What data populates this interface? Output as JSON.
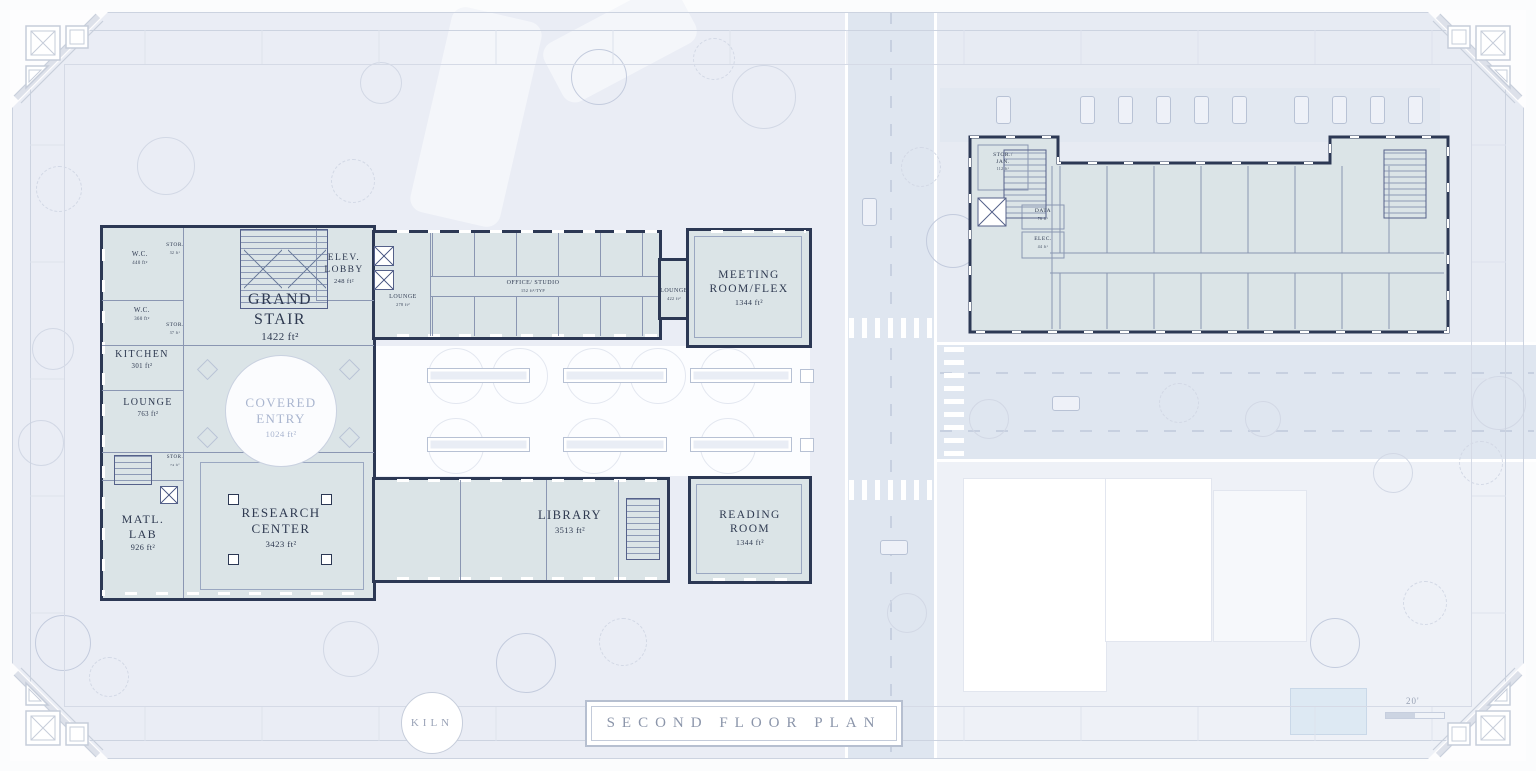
{
  "titleblock": {
    "title": "SECOND FLOOR PLAN"
  },
  "badge": {
    "label": "KILN"
  },
  "scale": {
    "label": "20'"
  },
  "colors": {
    "wall": "#2c3854",
    "room_fill": "#dbe4e7",
    "site": "#eaedf5",
    "road": "#dfe6f0",
    "label": "#2e3950",
    "light_label": "#a9b5cf"
  },
  "left_building": {
    "rooms": {
      "wc_north": {
        "name": "W.C.",
        "area": "440 ft²"
      },
      "stor_north": {
        "name": "STOR.",
        "area": "32 ft²"
      },
      "wc_south": {
        "name": "W.C.",
        "area": "360 ft²"
      },
      "stor_mid": {
        "name": "STOR.",
        "area": "37 ft²"
      },
      "kitchen": {
        "name": "KITCHEN",
        "area": "301 ft²"
      },
      "lounge_west": {
        "name": "LOUNGE",
        "area": "763 ft²"
      },
      "grand_stair": {
        "name": "GRAND STAIR",
        "area": "1422 ft²"
      },
      "elev_lobby": {
        "name": "ELEV. LOBBY",
        "area": "248 ft²"
      },
      "covered_entry": {
        "name": "COVERED ENTRY",
        "area": "1024 ft²"
      },
      "office_studio": {
        "name": "OFFICE/ STUDIO",
        "area": "152 ft²/TYP"
      },
      "lounge_mid": {
        "name": "LOUNGE",
        "area": "278 ft²"
      },
      "lounge_east": {
        "name": "LOUNGE",
        "area": "422 ft²"
      },
      "meeting_room": {
        "name": "MEETING ROOM/FLEX",
        "area": "1344 ft²"
      },
      "stor_south": {
        "name": "STOR.",
        "area": "74 ft²"
      },
      "matl_lab": {
        "name": "MATL. LAB",
        "area": "926 ft²"
      },
      "research_center": {
        "name": "RESEARCH CENTER",
        "area": "3423 ft²"
      },
      "library": {
        "name": "LIBRARY",
        "area": "3513 ft²"
      },
      "reading_room": {
        "name": "READING ROOM",
        "area": "1344 ft²"
      }
    }
  },
  "right_building": {
    "rooms": {
      "stor_jan": {
        "name": "STOR./ JAN.",
        "area": "112 ft²"
      },
      "data": {
        "name": "DATA",
        "area": "76 ft²"
      },
      "elec": {
        "name": "ELEC.",
        "area": "44 ft²"
      }
    }
  }
}
